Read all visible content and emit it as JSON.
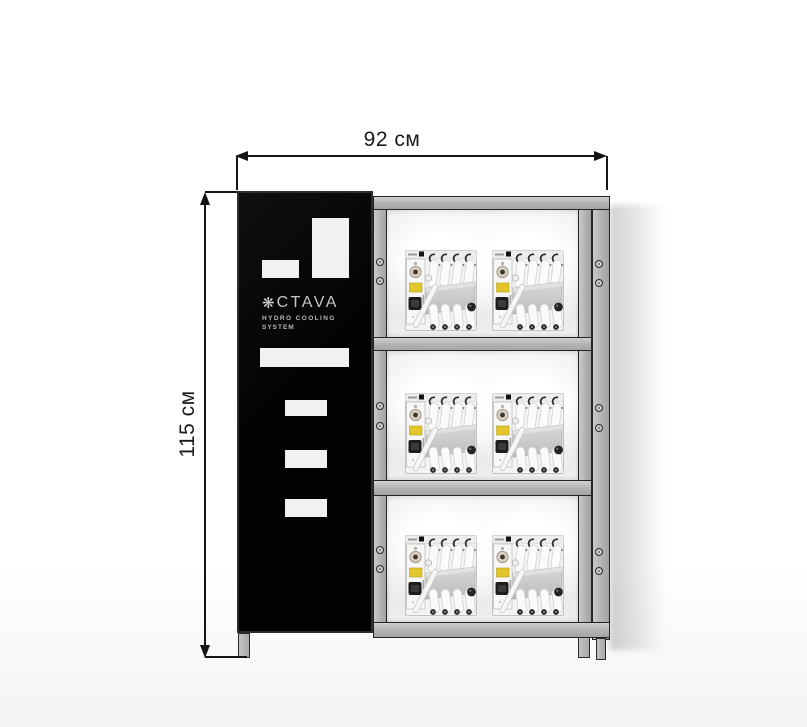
{
  "dimensions": {
    "width_label": "92 см",
    "height_label": "115 см"
  },
  "panel": {
    "brand_icon": "snowflake-icon",
    "brand_icon_glyph": "❋",
    "brand_text": "CTAVA",
    "subtitle_line1": "HYDRO COOLING",
    "subtitle_line2": "SYSTEM"
  },
  "rack": {
    "rows": 3,
    "units_per_row": 2,
    "total_units": 6
  },
  "colors": {
    "panel_black": "#050505",
    "frame_gray": "#b4b4b2",
    "frame_outline": "#242424",
    "dimension_line": "#141414",
    "unit_label_yellow": "#e3c52c",
    "background": "#ffffff"
  }
}
